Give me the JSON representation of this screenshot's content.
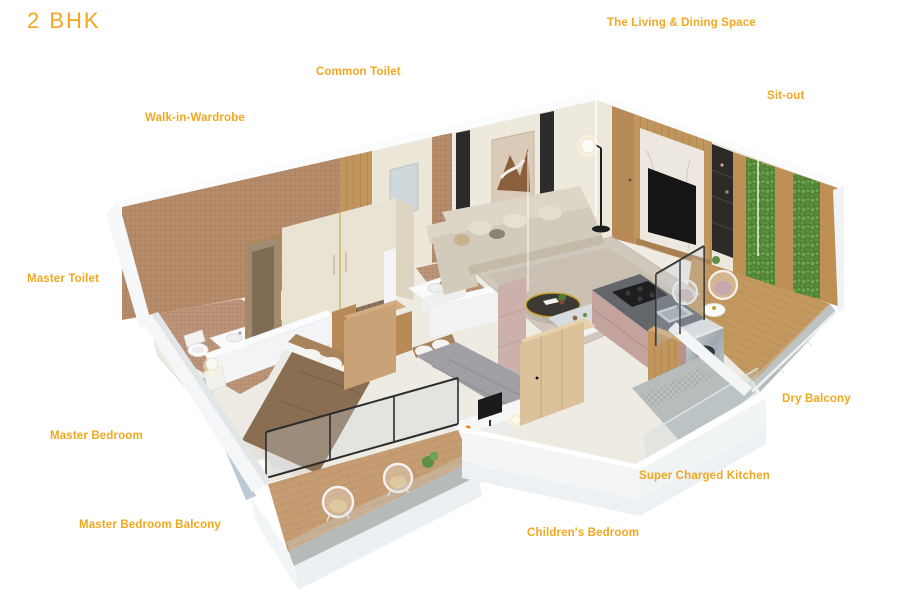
{
  "title": "2 BHK",
  "accent_color": "#F2A71E",
  "labels": {
    "living_dining": "The Living & Dining Space",
    "common_toilet": "Common Toilet",
    "sit_out": "Sit-out",
    "walk_in_wardrobe": "Walk-in-Wardrobe",
    "master_toilet": "Master Toilet",
    "master_bedroom": "Master Bedroom",
    "master_bedroom_balcony": "Master Bedroom Balcony",
    "childrens_bedroom": "Children's Bedroom",
    "super_charged_kitchen": "Super Charged Kitchen",
    "dry_balcony": "Dry Balcony"
  }
}
